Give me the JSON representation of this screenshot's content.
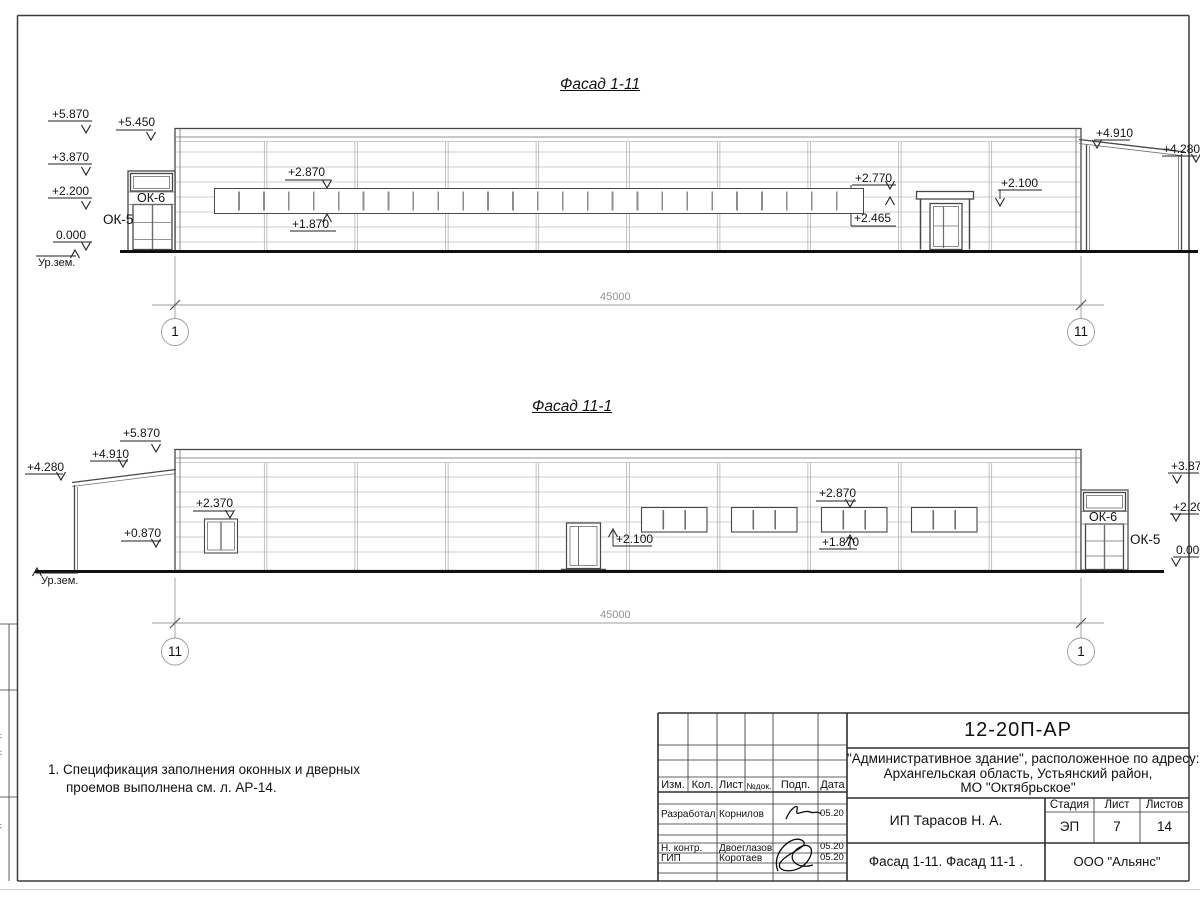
{
  "page": {
    "facade1": {
      "title": "Фасад 1-11",
      "dim": "45000",
      "axis_left": "1",
      "axis_right": "11",
      "marks": {
        "m5870": "+5.870",
        "m5450": "+5.450",
        "m3870": "+3.870",
        "m2200": "+2.200",
        "m0000": "0.000",
        "ground": "Ур.зем.",
        "ok6": "ОК-6",
        "ok5": "ОК-5",
        "band_top": "+2.870",
        "band_bottom": "+1.870",
        "band_end_top": "+2.770",
        "band_end_bottom": "+2.465",
        "door": "+2.100",
        "annex_near": "+4.910",
        "annex_far": "+4.280"
      }
    },
    "facade2": {
      "title": "Фасад 11-1",
      "dim": "45000",
      "axis_left": "11",
      "axis_right": "1",
      "marks": {
        "m5870": "+5.870",
        "m4910": "+4.910",
        "m4280": "+4.280",
        "m2370": "+2.370",
        "m0870": "+0.870",
        "ground": "Ур.зем.",
        "door": "+2.100",
        "band_top": "+2.870",
        "band_bottom": "+1.870",
        "ok6": "ОК-6",
        "ok5": "ОК-5",
        "right_3870": "+3.870",
        "right_2200": "+2.200",
        "right_0000": "0.000"
      }
    },
    "note": {
      "line1": "1. Спецификация заполнения оконных и дверных",
      "line2": "проемов выполнена см. л. АР-14."
    },
    "titleblock": {
      "code": "12-20П-АР",
      "project1": "\"Административное здание\", расположенное по адресу:",
      "project2": "Архангельская область, Устьянский район,",
      "project3": "МО \"Октябрьское\"",
      "col_izm": "Изм.",
      "col_kol": "Кол.",
      "col_list": "Лист",
      "col_ndok": "№док.",
      "col_podp": "Подп.",
      "col_data": "Дата",
      "r1_role": "Разработал",
      "r1_name": "Корнилов",
      "r1_date": "05.20",
      "r2_role": "Н. контр.",
      "r2_name": "Двоеглазов",
      "r2_date": "05.20",
      "r3_role": "ГИП",
      "r3_name": "Коротаев",
      "r3_date": "05.20",
      "client": "ИП Тарасов Н. А.",
      "stage_label": "Стадия",
      "sheet_label": "Лист",
      "sheets_label": "Листов",
      "stage": "ЭП",
      "sheet": "7",
      "sheets": "14",
      "sheet_title": "Фасад 1-11. Фасад 11-1 .",
      "company": "ООО \"Альянс\""
    },
    "side_strip": {
      "c1": "Взам. инв. №",
      "c2": "Подп. и дата",
      "c3": "Инв. № подл."
    }
  }
}
